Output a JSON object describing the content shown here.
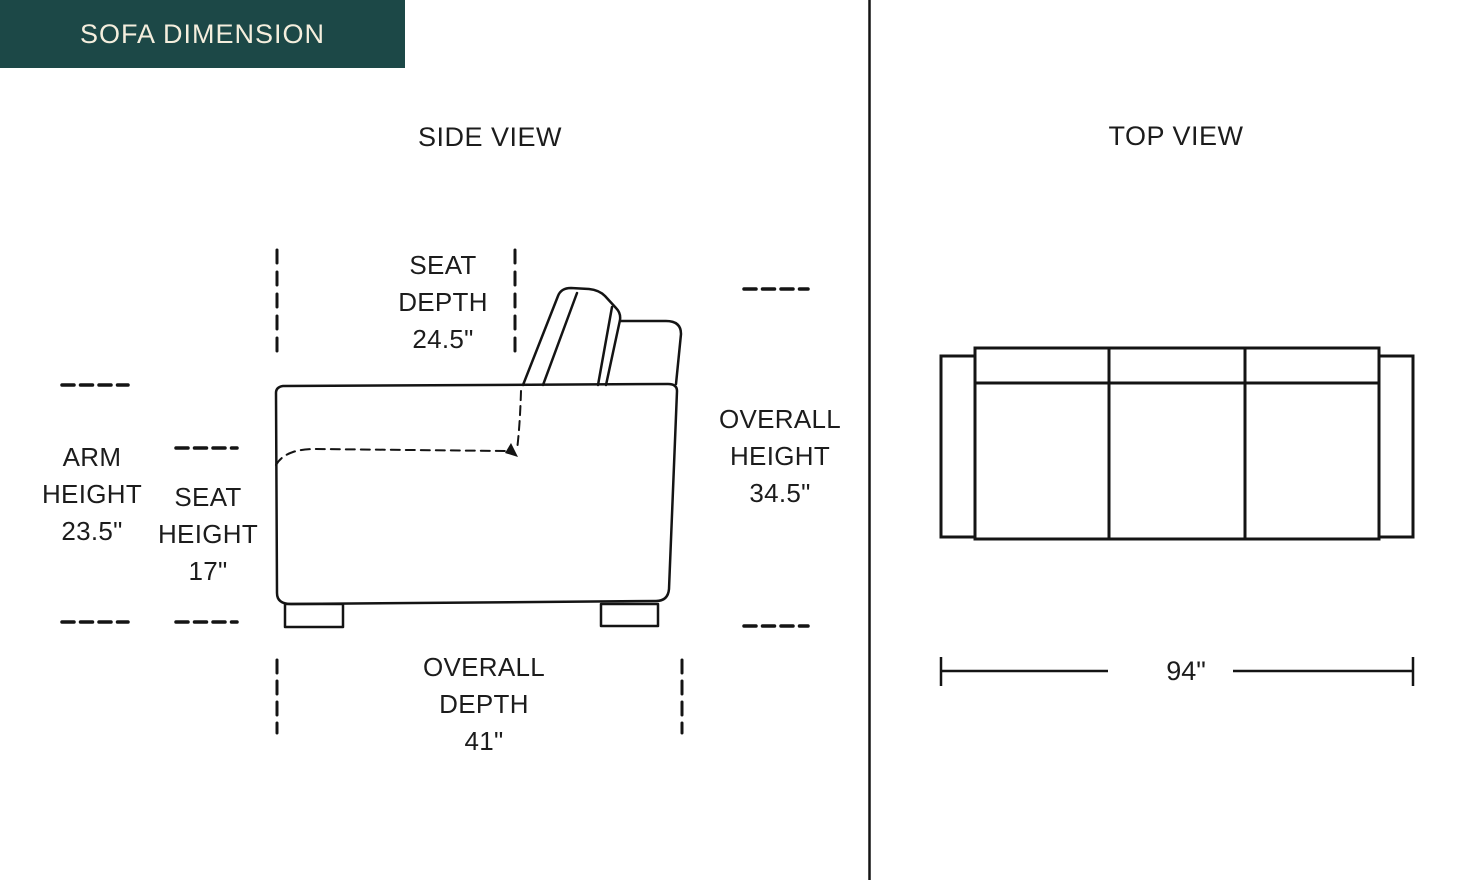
{
  "header": {
    "title": "SOFA DIMENSION",
    "bg_color": "#1c4847",
    "text_color": "#f4eedd"
  },
  "colors": {
    "line": "#141414",
    "text": "#1c1c1c",
    "background": "#ffffff"
  },
  "side_view": {
    "title": "SIDE VIEW",
    "labels": {
      "seat_depth": "SEAT\nDEPTH\n24.5\"",
      "arm_height": "ARM\nHEIGHT\n23.5\"",
      "seat_height": "SEAT\nHEIGHT\n17\"",
      "overall_height": "OVERALL\nHEIGHT\n34.5\"",
      "overall_depth": "OVERALL\nDEPTH\n41\""
    }
  },
  "top_view": {
    "title": "TOP VIEW",
    "labels": {
      "overall_width": "94\""
    }
  }
}
